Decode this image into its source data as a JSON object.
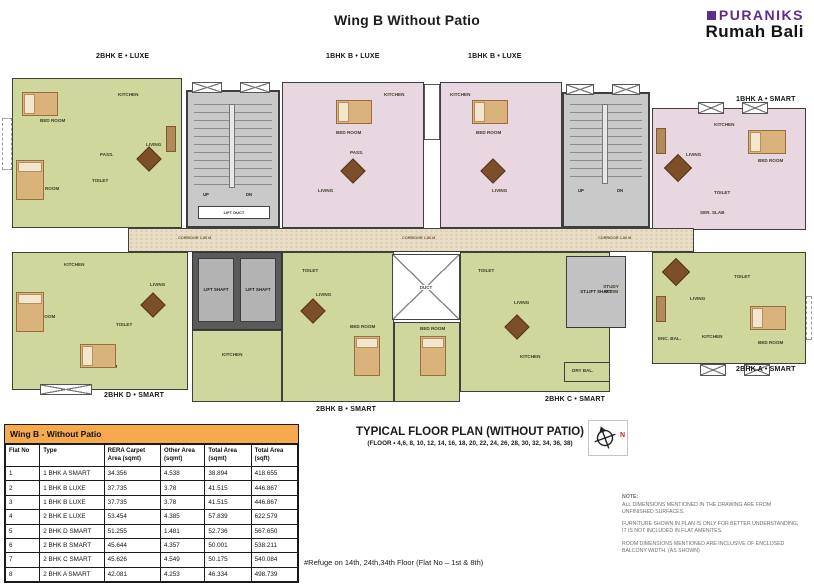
{
  "header": {
    "title": "Wing B Without Patio",
    "brand_name": "PURANIKS",
    "brand_sub": "Rumah Bali"
  },
  "plan": {
    "unit_labels": {
      "top_left": "2BHK E • LUXE",
      "top_mid_left": "1BHK B • LUXE",
      "top_mid_right": "1BHK B • LUXE",
      "right_top": "1BHK A • SMART",
      "right_bottom": "2BHK A • SMART",
      "bottom_left": "2BHK D • SMART",
      "bottom_mid": "2BHK B • SMART",
      "bottom_right": "2BHK C • SMART"
    },
    "core_labels": {
      "lift_shaft": "LIFT SHAFT",
      "st_lift_shaft": "ST.LIFT SHAFT",
      "lift_duct": "LIFT DUCT",
      "corridor": "CORRIDOR 1.80 M",
      "duct": "DUCT",
      "up": "UP",
      "dn": "DN"
    },
    "room_labels": {
      "living": "LIVING",
      "kitchen": "KITCHEN",
      "bedroom": "BED ROOM",
      "toilet": "TOILET",
      "study": "STUDY ROOM",
      "dry_bal": "DRY BAL.",
      "enc_bal": "ENC. BAL.",
      "pass": "PASS.",
      "ser_slab": "SER. SLAB"
    }
  },
  "table": {
    "title": "Wing B - Without Patio",
    "columns": [
      "Flat No",
      "Type",
      "RERA Carpet Area (sqmt)",
      "Other Area (sqmt)",
      "Total Area (sqmt)",
      "Total Area (sqft)"
    ],
    "rows": [
      [
        "1",
        "1 BHK A SMART",
        "34.356",
        "4.538",
        "38.894",
        "418.655"
      ],
      [
        "2",
        "1 BHK B LUXE",
        "37.735",
        "3.78",
        "41.515",
        "446.867"
      ],
      [
        "3",
        "1 BHK B LUXE",
        "37.735",
        "3.78",
        "41.515",
        "446.867"
      ],
      [
        "4",
        "2 BHK E LUXE",
        "53.454",
        "4.385",
        "57.839",
        "622.579"
      ],
      [
        "5",
        "2 BHK D SMART",
        "51.255",
        "1.481",
        "52.736",
        "567.650"
      ],
      [
        "6",
        "2 BHK B SMART",
        "45.644",
        "4.357",
        "50.001",
        "538.211"
      ],
      [
        "7",
        "2 BHK C SMART",
        "45.626",
        "4.549",
        "50.175",
        "540.084"
      ],
      [
        "8",
        "2 BHK A SMART",
        "42.081",
        "4.253",
        "46.334",
        "498.739"
      ]
    ]
  },
  "caption": {
    "title": "TYPICAL FLOOR PLAN (WITHOUT PATIO)",
    "floors": "(FLOOR • 4,6, 8, 10, 12, 14, 16, 18, 20, 22, 24, 26, 28, 30, 32, 34, 36, 38)",
    "refuge": "#Refuge on 14th, 24th,34th Floor (Flat No – 1st & 8th)",
    "compass_n": "N"
  },
  "notes": {
    "heading": "NOTE:",
    "items": [
      "ALL DIMENSIONS MENTIONED IN THE DRAWING ARE FROM UNFINISHED SURFACES.",
      "FURNITURE SHOWN IN PLAN IS ONLY FOR BETTER UNDERSTANDING, IT IS NOT INCLUDED IN FLAT AMENITES.",
      "ROOM DIMENSIONS MENTIONED ARE INCLUSIVE OF ENCLOSED BALCONY WIDTH. (AS SHOWN)"
    ]
  },
  "colors": {
    "green_unit": "#cfd79c",
    "pink_unit": "#e8d7e0",
    "corridor": "#e8dec6",
    "shaft_gray": "#c9c9c9",
    "wall": "#3f3f3f",
    "table_header": "#f7a94e",
    "brand_purple": "#5b2d90"
  }
}
